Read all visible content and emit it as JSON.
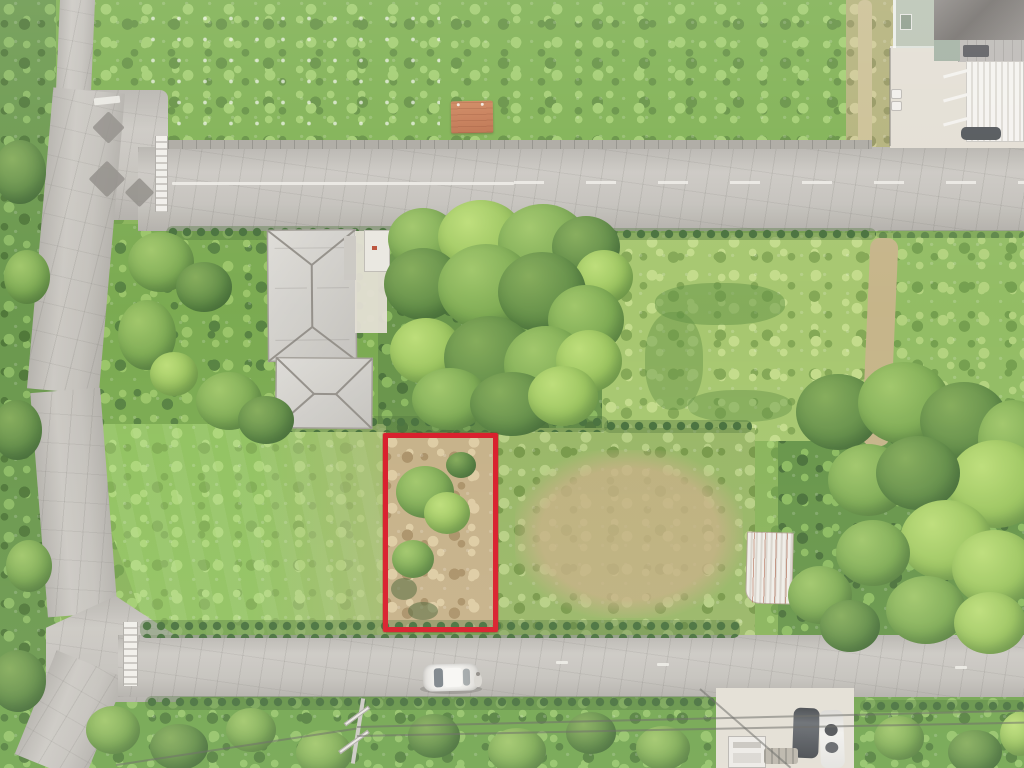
{
  "scene": {
    "type": "aerial-drone-photograph",
    "description": "Overhead drone photo of a rural neighborhood: an upper and a lower gray asphalt road connected by a side road on the left, a house with gray hip roofs, dense tree clusters, green fields and lawns, and a vacant overgrown parcel outlined by a red rectangle annotation; a white car is parked on the lower road.",
    "annotation": {
      "name": "parcel-outline",
      "shape": "rectangle",
      "x": 383,
      "y": 433,
      "width": 115,
      "height": 199,
      "stroke_width": 5,
      "color": "#d6101e"
    },
    "objects": [
      "upper-road",
      "lower-road",
      "side-road",
      "intersection",
      "road-center-line",
      "gray-hip-roof-house",
      "secondary-hip-roof",
      "driveway",
      "entrance-structure",
      "tree-cluster-center",
      "tree-cluster-right",
      "mowed-lawn",
      "overgrown-parcel",
      "rusted-metal-shed-roof",
      "orange-shed-roof",
      "neighbor-house",
      "carport",
      "white-car",
      "person",
      "dark-car",
      "white-suv",
      "white-truck",
      "utility-pole",
      "power-lines",
      "parking-area",
      "roadside-hedges",
      "patched-asphalt-diamonds"
    ],
    "colors": {
      "annotation_red": "#d6101e",
      "road": "#c2bfb9",
      "road_patch": "#8b8882",
      "lattice_white": "#f0eee9",
      "grass_base": "#85b354",
      "grass_lush": "#79ad4a",
      "grass_light": "#9ecb6a",
      "lawn": "#8cbf58",
      "dry_grass": "#c3ad82",
      "hedge_dark": "#3f6a33",
      "tree_light": "#9cc463",
      "tree_dark": "#47713a",
      "concrete": "#e2ddd2",
      "roof_gray": "#d2d0cb",
      "roof_dark": "#7d7975",
      "orange_roof": "#b96a44",
      "vehicle_white": "#eceae5",
      "vehicle_dark": "#494d51"
    }
  }
}
